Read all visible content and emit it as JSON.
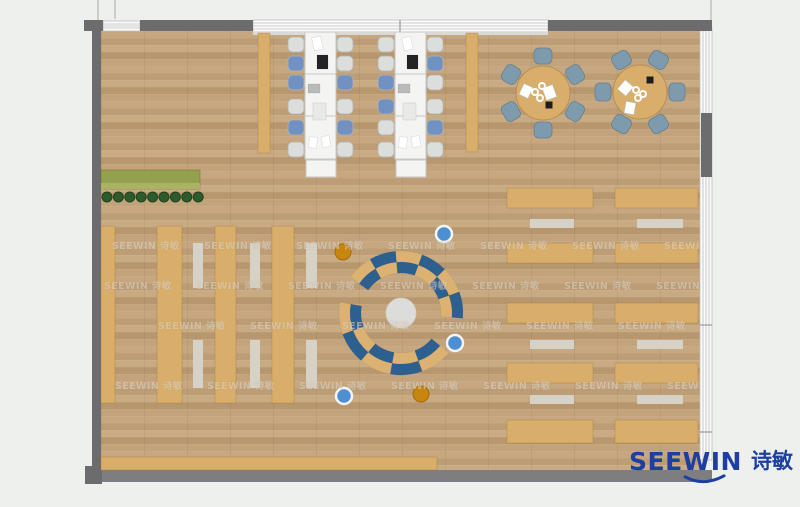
{
  "palette": {
    "outside": "#eef0ee",
    "wallDark": "#6c6c6e",
    "wallMid": "#7e7e80",
    "windowFace": "#fbfbfb",
    "windowLine": "#bcbcbe",
    "mullion": "#9a9a9c",
    "sill": "#d9d9d7",
    "outsideLine": "#cccccc",
    "floorBase": "#c2a37c",
    "tan": "#d9ae6b",
    "tanEdge": "rgba(150,105,45,0.35)",
    "mat": "#d6d2c8",
    "deskWhite": "#f4f4f3",
    "deskEdge": "#c6c6c4",
    "chairBlue": "#7191c3",
    "chairGray": "#dcdedc",
    "chairEdge": "#b2b5b3",
    "chairSteel": "#7e9aad",
    "steelEdge": "#64808f",
    "benchBlue": "#2e608f",
    "benchTan": "#dcb273",
    "rug": "#dcdcda",
    "stoolBlue": "#4e8fd3",
    "stoolOrange": "#c8860f",
    "plant": "#2e5b2b",
    "plantEdge": "#1e431d",
    "planter": "#93a04c",
    "planterLight": "#a9b463",
    "paper": "#ffffff",
    "laptop": "#242426",
    "tablet": "#b9bbba",
    "pad": "#e9e9e7",
    "black": "#1d1d1f",
    "logoBlue": "#1e3fa2",
    "watermarkColor": "rgba(248,243,233,0.46)"
  },
  "logo": {
    "en": "SEEWIN",
    "zh": "诗敏"
  },
  "watermark": {
    "text": "SEEWIN 诗敏",
    "rows": [
      {
        "y": 244,
        "x0": 112,
        "step": 92,
        "n": 7
      },
      {
        "y": 284,
        "x0": 104,
        "step": 92,
        "n": 7
      },
      {
        "y": 324,
        "x0": 158,
        "step": 92,
        "n": 6
      },
      {
        "y": 384,
        "x0": 115,
        "step": 92,
        "n": 7
      }
    ]
  },
  "plan": {
    "size": {
      "w": 800,
      "h": 507
    },
    "floor": {
      "x": 101,
      "y": 31,
      "w": 599,
      "h": 439
    },
    "outside_lines": [
      {
        "x": 97,
        "y": 0,
        "w": 2,
        "h": 21
      },
      {
        "x": 114,
        "y": 0,
        "w": 2,
        "h": 19
      },
      {
        "x": 710,
        "y": 0,
        "w": 2,
        "h": 20
      }
    ],
    "windows": [
      {
        "name": "window-top-left",
        "x": 103,
        "y": 21,
        "w": 37,
        "h": 10,
        "dir": "h",
        "dividers": []
      },
      {
        "name": "window-top-main",
        "x": 253,
        "y": 20,
        "w": 295,
        "h": 12,
        "dir": "h",
        "dividers": [
          400
        ],
        "sill": true
      },
      {
        "name": "window-right",
        "x": 700,
        "y": 28,
        "w": 12,
        "h": 432,
        "dir": "v",
        "dividers": [
          325,
          432
        ]
      }
    ],
    "walls": [
      {
        "name": "wall-top-corner-left",
        "x": 84,
        "y": 20,
        "w": 19,
        "h": 11,
        "c": "wallDark"
      },
      {
        "name": "wall-top-1",
        "x": 140,
        "y": 20,
        "w": 113,
        "h": 11,
        "c": "wallDark"
      },
      {
        "name": "wall-top-2",
        "x": 548,
        "y": 20,
        "w": 164,
        "h": 11,
        "c": "wallDark"
      },
      {
        "name": "wall-left",
        "x": 92,
        "y": 20,
        "w": 9,
        "h": 452,
        "c": "wallDark"
      },
      {
        "name": "wall-right-pier",
        "x": 701,
        "y": 113,
        "w": 11,
        "h": 64,
        "c": "wallDark"
      },
      {
        "name": "wall-bottom",
        "x": 88,
        "y": 470,
        "w": 624,
        "h": 12,
        "c": "wallMid"
      },
      {
        "name": "wall-bottom-left-corner",
        "x": 85,
        "y": 466,
        "w": 17,
        "h": 18,
        "c": "wallDark"
      }
    ],
    "planter": {
      "x": 101,
      "y": 170,
      "w": 99,
      "h": 19
    },
    "plants": {
      "y": 197,
      "x0": 107,
      "step": 11.4,
      "n": 9,
      "r": 5
    },
    "bookshelves": [
      {
        "x": 101,
        "y": 226,
        "w": 14,
        "h": 177
      },
      {
        "x": 157,
        "y": 226,
        "w": 25,
        "h": 177
      },
      {
        "x": 215,
        "y": 226,
        "w": 21,
        "h": 177
      },
      {
        "x": 272,
        "y": 226,
        "w": 22,
        "h": 177
      }
    ],
    "aisle_mats": [
      {
        "x": 193,
        "y": 243,
        "w": 10,
        "h": 45
      },
      {
        "x": 193,
        "y": 340,
        "w": 10,
        "h": 48
      },
      {
        "x": 250,
        "y": 243,
        "w": 10,
        "h": 45
      },
      {
        "x": 250,
        "y": 340,
        "w": 10,
        "h": 48
      },
      {
        "x": 306,
        "y": 243,
        "w": 11,
        "h": 45
      },
      {
        "x": 306,
        "y": 340,
        "w": 11,
        "h": 48
      }
    ],
    "side_benches": [
      {
        "x": 258,
        "y": 33,
        "w": 12,
        "h": 120
      },
      {
        "x": 466,
        "y": 33,
        "w": 12,
        "h": 119
      }
    ],
    "workstations": {
      "y": 32,
      "w": 31,
      "h": 127,
      "divider_ys": [
        74,
        116
      ],
      "end_table": {
        "dx": 1,
        "dy": 128,
        "w": 30,
        "h": 17
      },
      "chair_ys": [
        37,
        56,
        75,
        99,
        120,
        142
      ],
      "chair_w": 16,
      "chair_h": 15,
      "columns": [
        {
          "x": 305,
          "chairs_left": {
            "x": 288,
            "colors": [
              "gray",
              "blue",
              "blue",
              "gray",
              "blue",
              "gray"
            ]
          },
          "chairs_right": {
            "x": 337,
            "colors": [
              "gray",
              "gray",
              "blue",
              "gray",
              "blue",
              "gray"
            ]
          }
        },
        {
          "x": 395,
          "chairs_left": {
            "x": 378,
            "colors": [
              "gray",
              "gray",
              "blue",
              "blue",
              "gray",
              "gray"
            ]
          },
          "chairs_right": {
            "x": 427,
            "colors": [
              "gray",
              "blue",
              "gray",
              "gray",
              "blue",
              "gray"
            ]
          }
        }
      ],
      "items": [
        {
          "dx": 8,
          "dy": 5,
          "w": 9,
          "h": 13,
          "rot": -12,
          "c": "paper"
        },
        {
          "dx": 12,
          "dy": 23,
          "w": 11,
          "h": 14,
          "rot": 0,
          "c": "laptop"
        },
        {
          "dx": 3,
          "dy": 52,
          "w": 12,
          "h": 9,
          "rot": 0,
          "c": "tablet"
        },
        {
          "dx": 8,
          "dy": 71,
          "w": 13,
          "h": 17,
          "rot": 0,
          "c": "pad"
        },
        {
          "dx": 4,
          "dy": 105,
          "w": 8,
          "h": 11,
          "rot": 8,
          "c": "paper"
        },
        {
          "dx": 17,
          "dy": 104,
          "w": 8,
          "h": 11,
          "rot": -10,
          "c": "paper"
        }
      ]
    },
    "round_chair": {
      "dist": 37,
      "w": 18,
      "h": 16
    },
    "round_tables": [
      {
        "cx": 543,
        "cy": 93,
        "r": 27,
        "chair_bearings": [
          0,
          60,
          120,
          180,
          240,
          300
        ],
        "papers": [
          {
            "dx": -22,
            "dy": -8,
            "w": 10,
            "h": 12,
            "rot": 25
          },
          {
            "dx": 1,
            "dy": -7,
            "w": 11,
            "h": 13,
            "rot": -20
          }
        ],
        "black": {
          "dx": 6,
          "dy": 12
        },
        "cups": [
          {
            "dx": -8,
            "dy": -1
          },
          {
            "dx": -3,
            "dy": 5
          },
          {
            "dx": -1,
            "dy": -7
          }
        ]
      },
      {
        "cx": 640,
        "cy": 92,
        "r": 27,
        "chair_bearings": [
          30,
          90,
          150,
          210,
          270,
          330
        ],
        "papers": [
          {
            "dx": -20,
            "dy": -10,
            "w": 11,
            "h": 12,
            "rot": 40
          },
          {
            "dx": -15,
            "dy": 10,
            "w": 10,
            "h": 12,
            "rot": 10
          }
        ],
        "black": {
          "dx": 10,
          "dy": -12
        },
        "cups": [
          {
            "dx": -4,
            "dy": -2
          },
          {
            "dx": 3,
            "dy": 2
          },
          {
            "dx": -2,
            "dy": 6
          }
        ]
      }
    ],
    "right_desks": {
      "columns": [
        {
          "x": 507,
          "w": 86,
          "mat_x": 530,
          "mat_w": 44
        },
        {
          "x": 615,
          "w": 83,
          "mat_x": 637,
          "mat_w": 46
        }
      ],
      "rows": [
        {
          "y": 188,
          "h": 20
        },
        {
          "y": 243,
          "h": 20
        },
        {
          "y": 303,
          "h": 20
        },
        {
          "y": 363,
          "h": 20
        },
        {
          "y": 420,
          "h": 23
        }
      ],
      "mat_rows": [
        {
          "y": 219,
          "h": 9
        },
        {
          "y": 340,
          "h": 9
        },
        {
          "y": 395,
          "h": 9
        }
      ]
    },
    "reading_circle": {
      "cx": 401,
      "cy": 313,
      "rug_r": 15,
      "r0": 40,
      "r1": 51,
      "r2": 62,
      "arcs": [
        {
          "start": 305,
          "sweep": 150,
          "outer": [
            "benchTan",
            "benchBlue",
            "benchTan",
            "benchBlue",
            "benchTan",
            "benchBlue"
          ],
          "inner": [
            "benchBlue",
            "benchTan",
            "benchBlue",
            "benchTan",
            "benchBlue",
            "benchTan"
          ]
        },
        {
          "start": 130,
          "sweep": 150,
          "outer": [
            "benchTan",
            "benchBlue",
            "benchTan",
            "benchBlue",
            "benchTan"
          ],
          "inner": [
            "benchBlue",
            "benchTan",
            "benchBlue",
            "benchTan",
            "benchBlue"
          ]
        }
      ]
    },
    "stools": [
      {
        "cx": 343,
        "cy": 252,
        "r": 8,
        "k": "orange"
      },
      {
        "cx": 421,
        "cy": 394,
        "r": 8,
        "k": "orange"
      },
      {
        "cx": 444,
        "cy": 234,
        "r": 8,
        "k": "blue"
      },
      {
        "cx": 455,
        "cy": 343,
        "r": 8,
        "k": "blue"
      },
      {
        "cx": 344,
        "cy": 396,
        "r": 8,
        "k": "blue"
      }
    ],
    "bottom_bench": {
      "x": 101,
      "y": 457,
      "w": 336,
      "h": 13
    }
  }
}
